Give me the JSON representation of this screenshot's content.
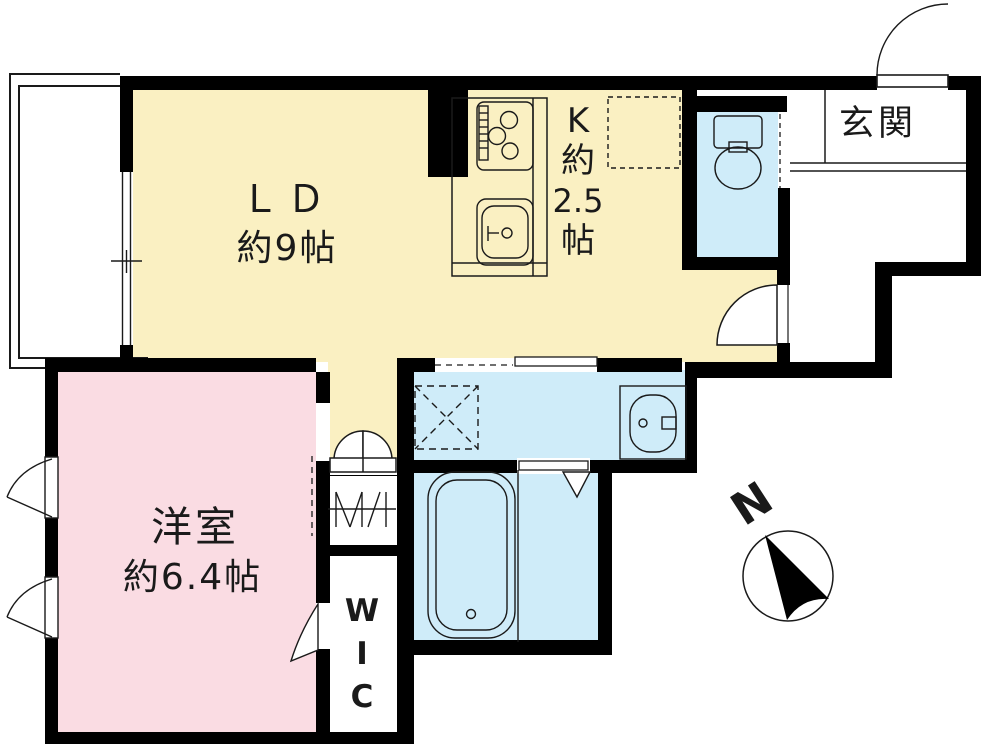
{
  "plan_title": "apartment-floor-plan",
  "rooms": {
    "living_dining": {
      "name": "ＬＤ",
      "size": "約9帖",
      "color": "#FAF0C2"
    },
    "kitchen": {
      "label_lines": [
        "K",
        "約",
        "2.5",
        "帖"
      ],
      "color": "#FAF0C2"
    },
    "western_room": {
      "name": "洋室",
      "size": "約6.4帖",
      "color": "#FADCE3"
    },
    "entrance": {
      "name": "玄関"
    },
    "walk_in_closet": {
      "label_lines": [
        "W",
        "I",
        "C"
      ]
    }
  },
  "compass": {
    "north_label": "N"
  },
  "fixtures": [
    "stove",
    "kitchen-sink",
    "refrigerator-space",
    "toilet-fixture",
    "washing-machine-space",
    "washbasin",
    "bathtub"
  ],
  "colors": {
    "ld_kitchen_fill": "#FAF0C2",
    "western_room_fill": "#FADCE3",
    "wet_area_fill": "#CFECF9",
    "wall": "#000000",
    "line": "#1a1a1a"
  }
}
